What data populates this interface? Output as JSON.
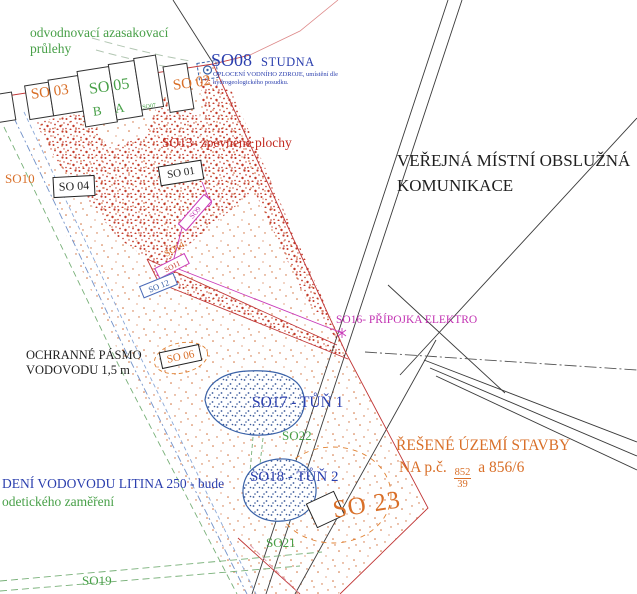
{
  "colors": {
    "orange": "#d96f28",
    "green": "#48a048",
    "red": "#c22b22",
    "navy": "#2b3fae",
    "pond_blue": "#3a62a8",
    "magenta": "#c232b2",
    "black": "#1f1f1f",
    "stipple_dense": "#c33a2a",
    "stipple_sparse": "#cf6b35"
  },
  "labels": {
    "swales_line1": "odvodnovací azasakovací",
    "swales_line2": "průlehy",
    "well_code": "SO08",
    "well_name": "STUDNA",
    "well_note1": "OPLOCENÍ VODNÍHO ZDROJE, umístění dle",
    "well_note2": "hydrogeologického posudku.",
    "so03": "SO 03",
    "so05": "SO 05",
    "so05_b": "B",
    "so05_a": "A",
    "so07": "SO07",
    "so02": "SO 02",
    "so13": "SO13- zpevněné plochy",
    "so10": "SO10",
    "so04": "SO 04",
    "so01": "SO 01",
    "road_line1": "VEŘEJNÁ MÍSTNÍ OBSLUŽNÁ",
    "road_line2": "KOMUNIKACE",
    "so09": "SO9",
    "so14": "SO14",
    "so11": "SO11",
    "so12": "SO 12",
    "so16": "SO16- PŘÍPOJKA ELEKTRO",
    "pasmo_line1": "OCHRANNÉ PÁSMO",
    "pasmo_line2": "VODOVODU 1,5 m",
    "so06": "SO 06",
    "pond1": "SO17 - TŮŇ 1",
    "so22": "SO22",
    "pond2": "SO18 - TŮŇ 2",
    "so21": "SO21",
    "area_line1": "ŘEŠENÉ ÚZEMÍ STAVBY",
    "area_prefix": "NA p.č.",
    "area_frac_num": "852",
    "area_frac_den": "39",
    "area_suffix": "a 856/6",
    "so23": "SO 23",
    "vodovod_line1": "DENÍ VODOVODU LITINA 250 - bude",
    "vodovod_line2": "odetického zaměření",
    "so19": "SO19"
  }
}
